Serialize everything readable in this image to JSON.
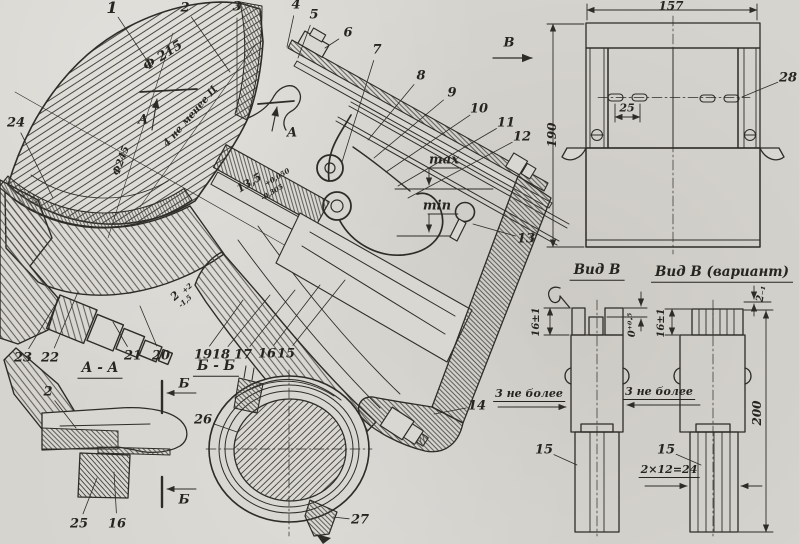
{
  "drawing": {
    "description": "Sectional assembly drawing of an air-cleaner / carburetor unit with auxiliary views",
    "paper_color": "#d6d4ce",
    "ink_color": "#2d2c27",
    "view_titles": [
      {
        "t": "А - А",
        "x": 100,
        "y": 370
      },
      {
        "t": "Б - Б",
        "x": 216,
        "y": 368
      },
      {
        "t": "Вид В",
        "x": 597,
        "y": 272
      },
      {
        "t": "Вид В (вариант)",
        "x": 722,
        "y": 274
      }
    ],
    "callouts": [
      {
        "n": "1",
        "x": 112,
        "y": 8,
        "lx": 148,
        "ly": 62,
        "em": true
      },
      {
        "n": "2",
        "x": 185,
        "y": 8,
        "lx": 230,
        "ly": 72
      },
      {
        "n": "3",
        "x": 237,
        "y": 7,
        "lx": 237,
        "ly": 112
      },
      {
        "n": "4",
        "x": 296,
        "y": 5,
        "lx": 287,
        "ly": 47
      },
      {
        "n": "5",
        "x": 314,
        "y": 15,
        "lx": 298,
        "ly": 58
      },
      {
        "n": "6",
        "x": 348,
        "y": 33,
        "lx": 325,
        "ly": 48
      },
      {
        "n": "7",
        "x": 377,
        "y": 50,
        "lx": 342,
        "ly": 162
      },
      {
        "n": "8",
        "x": 421,
        "y": 76,
        "lx": 368,
        "ly": 140
      },
      {
        "n": "9",
        "x": 452,
        "y": 93,
        "lx": 374,
        "ly": 158
      },
      {
        "n": "10",
        "x": 479,
        "y": 109,
        "lx": 386,
        "ly": 172
      },
      {
        "n": "11",
        "x": 506,
        "y": 123,
        "lx": 398,
        "ly": 186
      },
      {
        "n": "12",
        "x": 522,
        "y": 137,
        "lx": 408,
        "ly": 198
      },
      {
        "n": "13",
        "x": 526,
        "y": 239,
        "lx": 473,
        "ly": 224
      },
      {
        "n": "14",
        "x": 477,
        "y": 406,
        "lx": 434,
        "ly": 414
      },
      {
        "n": "15",
        "x": 286,
        "y": 354,
        "lx": 345,
        "ly": 280
      },
      {
        "n": "16",
        "x": 267,
        "y": 354,
        "lx": 320,
        "ly": 285
      },
      {
        "n": "17",
        "x": 243,
        "y": 355,
        "lx": 295,
        "ly": 290
      },
      {
        "n": "18",
        "x": 221,
        "y": 355,
        "lx": 270,
        "ly": 295
      },
      {
        "n": "19",
        "x": 203,
        "y": 355,
        "lx": 243,
        "ly": 300
      },
      {
        "n": "20",
        "x": 161,
        "y": 356,
        "lx": 140,
        "ly": 306
      },
      {
        "n": "21",
        "x": 133,
        "y": 356,
        "lx": 113,
        "ly": 322
      },
      {
        "n": "22",
        "x": 50,
        "y": 358,
        "lx": 78,
        "ly": 292
      },
      {
        "n": "23",
        "x": 23,
        "y": 358,
        "lx": 60,
        "ly": 297
      },
      {
        "n": "24",
        "x": 16,
        "y": 123,
        "lx": 53,
        "ly": 198
      },
      {
        "n": "25",
        "x": 79,
        "y": 524,
        "lx": 97,
        "ly": 478
      },
      {
        "n": "16",
        "x": 117,
        "y": 524,
        "lx": 114,
        "ly": 472
      },
      {
        "n": "2",
        "x": 48,
        "y": 392,
        "lx": 76,
        "ly": 428
      },
      {
        "n": "26",
        "x": 203,
        "y": 420,
        "lx": 237,
        "ly": 432
      },
      {
        "n": "27",
        "x": 360,
        "y": 520,
        "lx": 333,
        "ly": 517
      },
      {
        "n": "28",
        "x": 788,
        "y": 78,
        "lx": 742,
        "ly": 97
      },
      {
        "n": "15",
        "x": 544,
        "y": 450,
        "lx": 577,
        "ly": 465
      },
      {
        "n": "15",
        "x": 666,
        "y": 450,
        "lx": 701,
        "ly": 465
      }
    ],
    "labels": [
      {
        "t": "Ф 215",
        "x": 163,
        "y": 56,
        "r": -33,
        "s": 13
      },
      {
        "t": "Ф245",
        "x": 122,
        "y": 161,
        "r": -70,
        "s": 10
      },
      {
        "t": "4 не менее Ц",
        "x": 191,
        "y": 117,
        "r": -49,
        "s": 10
      },
      {
        "t": "13,5",
        "x": 249,
        "y": 183,
        "r": -31,
        "s": 11
      },
      {
        "t": "+0,050",
        "x": 277,
        "y": 177,
        "r": -31,
        "s": 7
      },
      {
        "t": "-0,305",
        "x": 272,
        "y": 192,
        "r": -31,
        "s": 7
      },
      {
        "t": "2",
        "x": 175,
        "y": 296,
        "r": -42,
        "s": 11
      },
      {
        "t": "+2",
        "x": 187,
        "y": 288,
        "r": -42,
        "s": 7
      },
      {
        "t": "-1,5",
        "x": 185,
        "y": 301,
        "r": -42,
        "s": 7
      },
      {
        "t": "max",
        "x": 444,
        "y": 160,
        "r": 0,
        "s": 13
      },
      {
        "t": "min",
        "x": 437,
        "y": 206,
        "r": 0,
        "s": 13
      },
      {
        "t": "А",
        "x": 143,
        "y": 120,
        "r": 0,
        "s": 13
      },
      {
        "t": "А",
        "x": 292,
        "y": 133,
        "r": 0,
        "s": 13
      },
      {
        "t": "В",
        "x": 509,
        "y": 43,
        "r": 0,
        "s": 13
      },
      {
        "t": "Б",
        "x": 184,
        "y": 384,
        "r": 0,
        "s": 13
      },
      {
        "t": "Б",
        "x": 184,
        "y": 500,
        "r": 0,
        "s": 13
      },
      {
        "t": "157",
        "x": 671,
        "y": 6,
        "r": 0,
        "s": 12
      },
      {
        "t": "190",
        "x": 552,
        "y": 135,
        "r": -90,
        "s": 12
      },
      {
        "t": "25",
        "x": 627,
        "y": 108,
        "r": 0,
        "s": 11
      },
      {
        "t": "16±1",
        "x": 537,
        "y": 322,
        "r": -90,
        "s": 10
      },
      {
        "t": "0⁺⁰·⁵",
        "x": 633,
        "y": 325,
        "r": -90,
        "s": 10
      },
      {
        "t": "16±1",
        "x": 662,
        "y": 323,
        "r": -90,
        "s": 10
      },
      {
        "t": "2₋₁",
        "x": 762,
        "y": 294,
        "r": -80,
        "s": 10
      },
      {
        "t": "3 не более",
        "x": 529,
        "y": 395,
        "r": 0,
        "s": 11,
        "u": true
      },
      {
        "t": "3 не более",
        "x": 659,
        "y": 393,
        "r": 0,
        "s": 11,
        "u": true
      },
      {
        "t": "2×12=24",
        "x": 669,
        "y": 471,
        "r": 0,
        "s": 11,
        "u": true
      },
      {
        "t": "200",
        "x": 757,
        "y": 413,
        "r": -90,
        "s": 12
      }
    ]
  }
}
